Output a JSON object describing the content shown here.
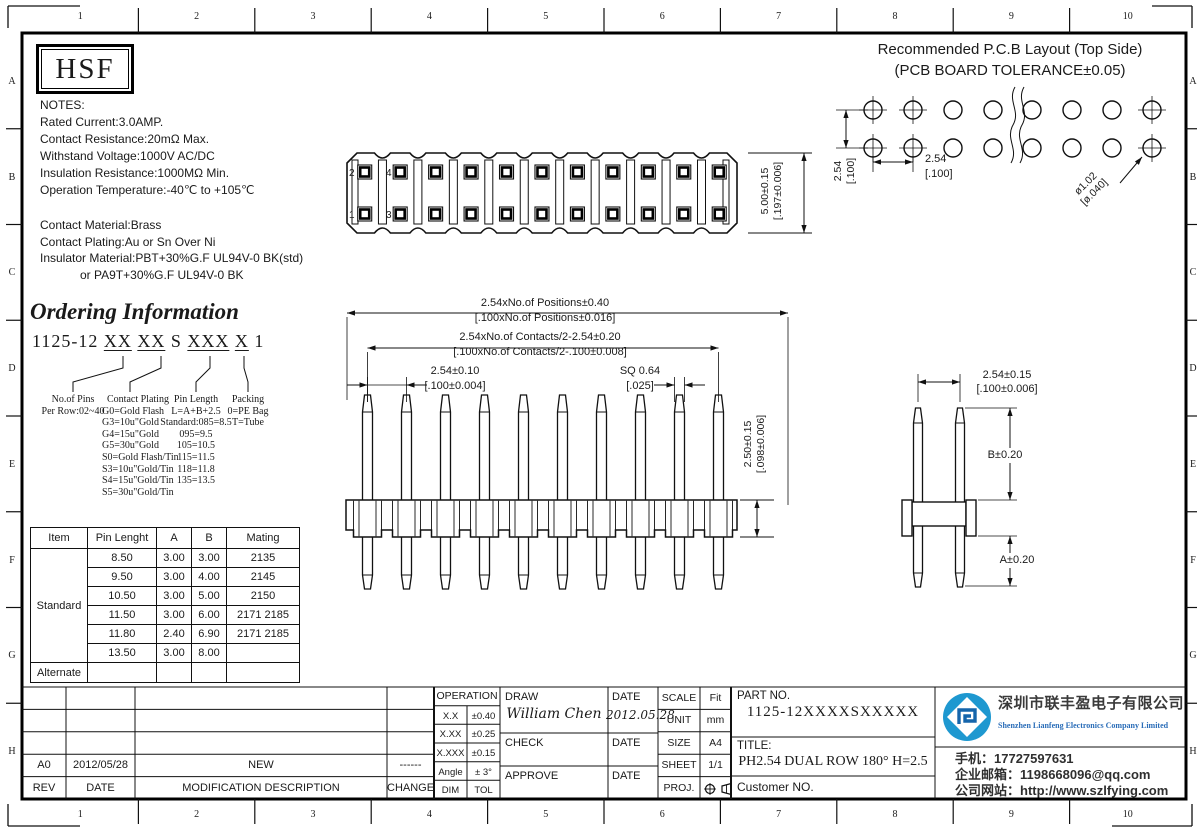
{
  "colors": {
    "ink": "#1a1a1a",
    "accent_blue": "#1e98d0",
    "company_blue": "#2a6db8"
  },
  "border": {
    "cols": [
      "1",
      "2",
      "3",
      "4",
      "5",
      "6",
      "7",
      "8",
      "9",
      "10"
    ],
    "rows": [
      "A",
      "B",
      "C",
      "D",
      "E",
      "F",
      "G",
      "H"
    ]
  },
  "logo": {
    "text": "HSF"
  },
  "notes": {
    "electrical": [
      "NOTES:",
      "Rated Current:3.0AMP.",
      "Contact Resistance:20mΩ Max.",
      "Withstand Voltage:1000V AC/DC",
      "Insulation Resistance:1000MΩ Min.",
      "Operation Temperature:-40℃ to +105℃"
    ],
    "material": [
      "Contact Material:Brass",
      "Contact Plating:Au or Sn Over Ni",
      "Insulator Material:PBT+30%G.F UL94V-0 BK(std)",
      "            or PA9T+30%G.F UL94V-0 BK"
    ]
  },
  "ordering": {
    "title": "Ordering Information",
    "part": [
      "1125-12 ",
      "XX",
      " ",
      "XX",
      " S ",
      "XXX",
      " ",
      "X",
      " 1"
    ],
    "columns": [
      {
        "header": "No.of Pins",
        "lines": [
          "Per Row:02~40"
        ]
      },
      {
        "header": "Contact Plating",
        "lines": [
          "G0=Gold Flash",
          "G3=10u\"Gold",
          "G4=15u\"Gold",
          "G5=30u\"Gold",
          "S0=Gold Flash/Tin",
          "S3=10u\"Gold/Tin",
          "S4=15u\"Gold/Tin",
          "S5=30u\"Gold/Tin"
        ]
      },
      {
        "header": "Pin Length",
        "lines": [
          "L=A+B+2.5",
          "Standard:085=8.5",
          "095=9.5",
          "105=10.5",
          "115=11.5",
          "118=11.8",
          "135=13.5"
        ]
      },
      {
        "header": "Packing",
        "lines": [
          "0=PE Bag",
          "T=Tube"
        ]
      }
    ]
  },
  "spec_table": {
    "headers": [
      "Item",
      "Pin Lenght",
      "A",
      "B",
      "Mating"
    ],
    "standard_label": "Standard",
    "rows": [
      [
        "8.50",
        "3.00",
        "3.00",
        "2135"
      ],
      [
        "9.50",
        "3.00",
        "4.00",
        "2145"
      ],
      [
        "10.50",
        "3.00",
        "5.00",
        "2150"
      ],
      [
        "11.50",
        "3.00",
        "6.00",
        "2171  2185"
      ],
      [
        "11.80",
        "2.40",
        "6.90",
        "2171  2185"
      ],
      [
        "13.50",
        "3.00",
        "8.00",
        ""
      ]
    ],
    "alternate_label": "Alternate"
  },
  "top_view": {
    "pin_labels": [
      "2",
      "1",
      "4",
      "3"
    ],
    "height_dim": [
      "5.00±0.15",
      "[.197±0.006]"
    ]
  },
  "front_view": {
    "positions_dim": [
      "2.54xNo.of Positions±0.40",
      "[.100xNo.of Positions±0.016]"
    ],
    "contacts_dim": [
      "2.54xNo.of Contacts/2-2.54±0.20",
      "[.100xNo.of Contacts/2-.100±0.008]"
    ],
    "pitch_dim": [
      "2.54±0.10",
      "[.100±0.004]"
    ],
    "sq_dim": [
      "SQ 0.64",
      "[.025]"
    ],
    "height_dim": [
      "2.50±0.15",
      "[.098±0.006]"
    ]
  },
  "side_view": {
    "pitch_dim": [
      "2.54±0.15",
      "[.100±0.006]"
    ],
    "b_dim": "B±0.20",
    "a_dim": "A±0.20"
  },
  "pcb": {
    "title1": "Recommended P.C.B Layout (Top Side)",
    "title2": "(PCB BOARD TOLERANCE±0.05)",
    "pitch_v": [
      "2.54",
      "[.100]"
    ],
    "pitch_h": [
      "2.54",
      "[.100]"
    ],
    "hole": [
      "ø1.02",
      "[ø.040]"
    ]
  },
  "revision": {
    "rows": [
      [
        "",
        "",
        "",
        ""
      ],
      [
        "",
        "",
        "",
        ""
      ],
      [
        "",
        "",
        "",
        ""
      ],
      [
        "A0",
        "2012/05/28",
        "NEW",
        "------"
      ],
      [
        "REV",
        "DATE",
        "MODIFICATION DESCRIPTION",
        "CHANGE"
      ]
    ]
  },
  "title_block": {
    "operation_header": "OPERATION",
    "tolerances": [
      [
        "X.X",
        "±0.40"
      ],
      [
        "X.XX",
        "±0.25"
      ],
      [
        "X.XXX",
        "±0.15"
      ],
      [
        "Angle",
        "± 3°"
      ],
      [
        "DIM",
        "TOL"
      ]
    ],
    "draw_label": "DRAW",
    "draw_name": "William Chen",
    "draw_date_label": "DATE",
    "draw_date": "2012.05.28",
    "check_label": "CHECK",
    "check_date_label": "DATE",
    "approve_label": "APPROVE",
    "approve_date_label": "DATE",
    "info": [
      [
        "SCALE",
        "Fit"
      ],
      [
        "UNIT",
        "mm"
      ],
      [
        "SIZE",
        "A4"
      ],
      [
        "SHEET",
        "1/1"
      ]
    ],
    "proj_label": "PROJ."
  },
  "part_block": {
    "part_label": "PART NO.",
    "part_no": "1125-12XXXXSXXXXX",
    "title_label": "TITLE:",
    "title": "PH2.54 DUAL ROW 180° H=2.5",
    "customer_label": "Customer NO."
  },
  "company": {
    "name_cn": "深圳市联丰盈电子有限公司",
    "name_en": "Shenzhen Lianfeng Electronics Company Limited",
    "phone": "手机：17727597631",
    "email": "企业邮箱：1198668096@qq.com",
    "website": "公司网站：http://www.szlfying.com"
  }
}
